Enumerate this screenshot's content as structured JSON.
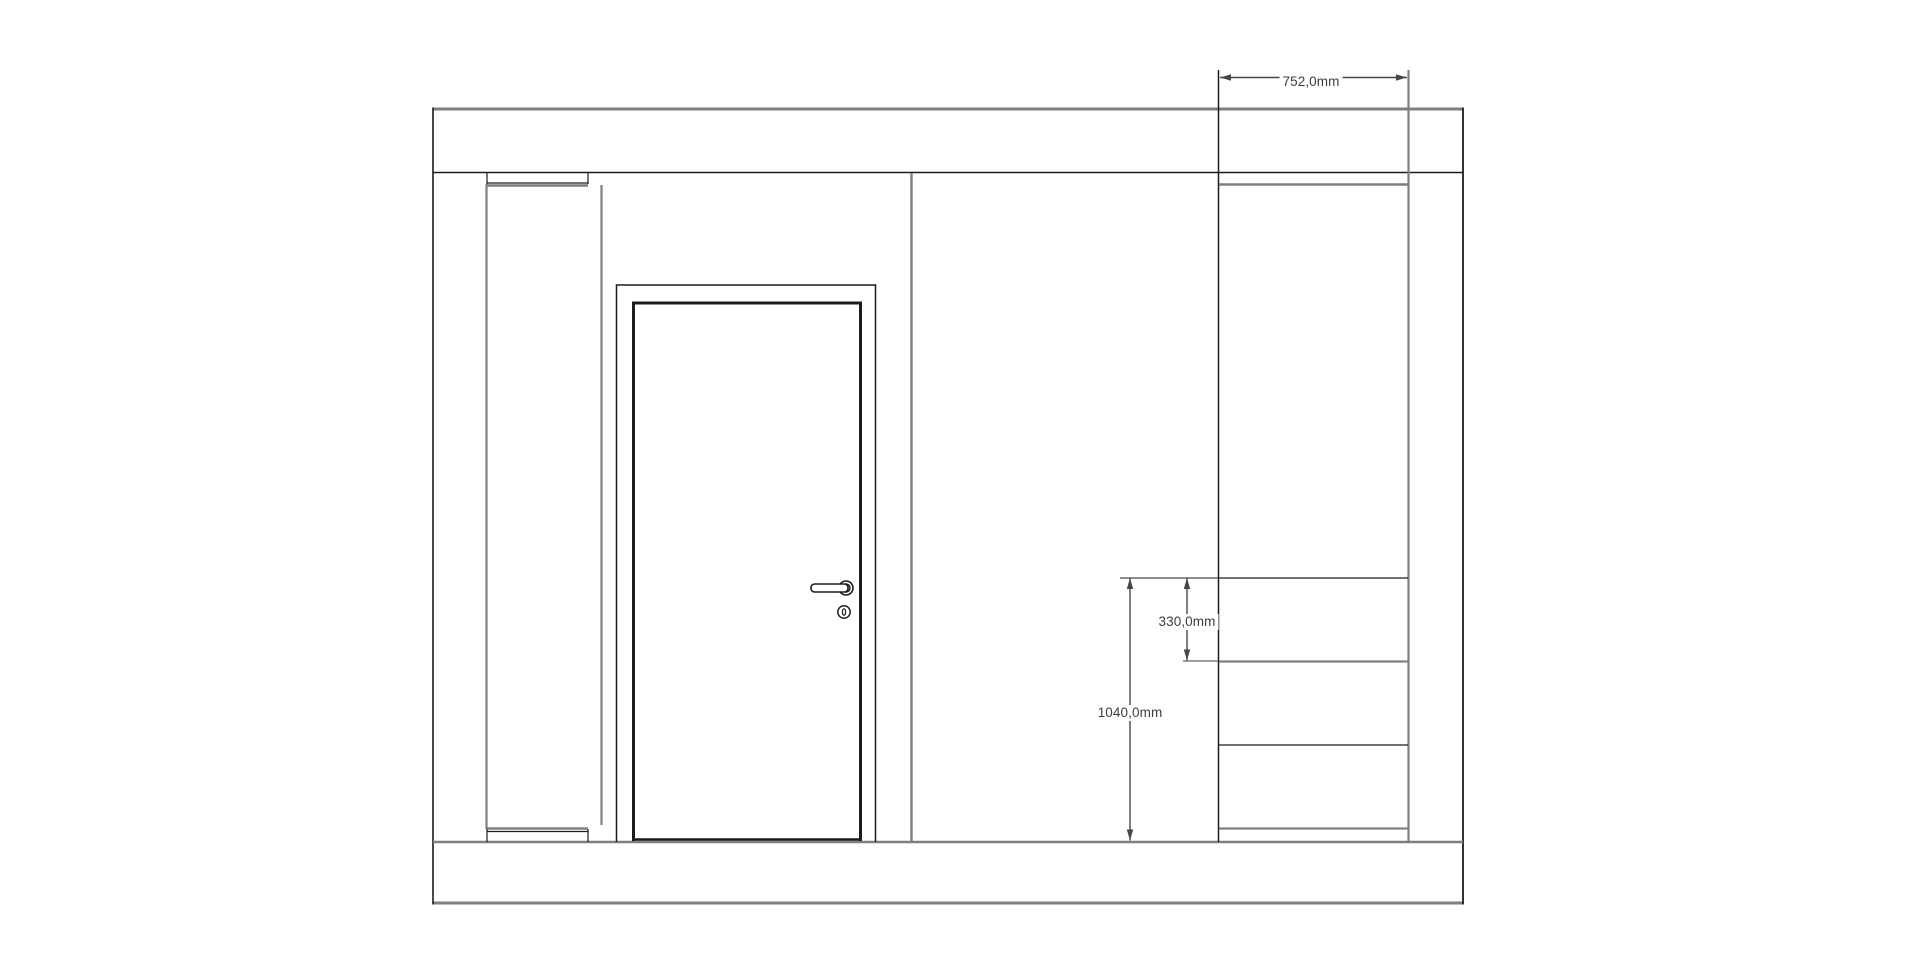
{
  "drawing": {
    "canvas": {
      "width": 1920,
      "height": 954,
      "background": "#ffffff"
    },
    "colors": {
      "gray": "#7f7f7f",
      "dark": "#1c1c1c",
      "dim": "#464646",
      "text": "#3d3d3d",
      "rose_fill": "#d8d8d8",
      "white": "#ffffff"
    },
    "segments": [
      {
        "name": "wall-top-edge",
        "x1": 433,
        "y1": 109,
        "x2": 1463,
        "y2": 109,
        "stroke": "gray",
        "w": 3
      },
      {
        "name": "wall-bottom-edge",
        "x1": 433,
        "y1": 903,
        "x2": 1463,
        "y2": 903,
        "stroke": "gray",
        "w": 3
      },
      {
        "name": "wall-left-edge",
        "x1": 433,
        "y1": 107.5,
        "x2": 433,
        "y2": 904.5,
        "stroke": "dark",
        "w": 1.6
      },
      {
        "name": "wall-right-edge",
        "x1": 1463,
        "y1": 107.5,
        "x2": 1463,
        "y2": 904.5,
        "stroke": "dark",
        "w": 1.8
      },
      {
        "name": "ceiling-line",
        "x1": 433,
        "y1": 172.5,
        "x2": 1463,
        "y2": 172.5,
        "stroke": "dark",
        "w": 1.4
      },
      {
        "name": "floor-line",
        "x1": 433,
        "y1": 842,
        "x2": 1463,
        "y2": 842,
        "stroke": "gray",
        "w": 2.6
      },
      {
        "name": "left-panel-side-edge",
        "x1": 486.5,
        "y1": 184,
        "x2": 486.5,
        "y2": 829,
        "stroke": "gray",
        "w": 2.2
      },
      {
        "name": "left-panel-top-line",
        "x1": 487,
        "y1": 183,
        "x2": 588,
        "y2": 183,
        "stroke": "dark",
        "w": 1.2
      },
      {
        "name": "left-panel-top-face",
        "x1": 486,
        "y1": 185.5,
        "x2": 588,
        "y2": 185.5,
        "stroke": "gray",
        "w": 2.4
      },
      {
        "name": "left-panel-top-stub-left",
        "x1": 487,
        "y1": 172,
        "x2": 487,
        "y2": 184,
        "stroke": "dark",
        "w": 1.2
      },
      {
        "name": "left-panel-top-stub-right",
        "x1": 588,
        "y1": 172,
        "x2": 588,
        "y2": 184,
        "stroke": "dark",
        "w": 1.2
      },
      {
        "name": "left-panel-bottom-face",
        "x1": 486,
        "y1": 828.5,
        "x2": 588,
        "y2": 828.5,
        "stroke": "gray",
        "w": 2.4
      },
      {
        "name": "left-panel-bottom-line",
        "x1": 487,
        "y1": 831.5,
        "x2": 588,
        "y2": 831.5,
        "stroke": "dark",
        "w": 1.2
      },
      {
        "name": "left-panel-bot-stub-left",
        "x1": 487,
        "y1": 829,
        "x2": 487,
        "y2": 842,
        "stroke": "dark",
        "w": 1.2
      },
      {
        "name": "left-panel-bot-stub-right",
        "x1": 588,
        "y1": 829,
        "x2": 588,
        "y2": 842,
        "stroke": "dark",
        "w": 1.2
      },
      {
        "name": "wall-corner-line",
        "x1": 601.5,
        "y1": 185,
        "x2": 601.5,
        "y2": 825,
        "stroke": "gray",
        "w": 2.2
      },
      {
        "name": "door-frame-left",
        "x1": 616.5,
        "y1": 285,
        "x2": 616.5,
        "y2": 842,
        "stroke": "dark",
        "w": 1.5
      },
      {
        "name": "door-frame-right",
        "x1": 875.5,
        "y1": 285,
        "x2": 875.5,
        "y2": 842,
        "stroke": "dark",
        "w": 1.5
      },
      {
        "name": "door-frame-top",
        "x1": 615.8,
        "y1": 285,
        "x2": 876.2,
        "y2": 285,
        "stroke": "dark",
        "w": 1.5
      },
      {
        "name": "door-slab-left",
        "x1": 633.5,
        "y1": 301.5,
        "x2": 633.5,
        "y2": 841,
        "stroke": "dark",
        "w": 3
      },
      {
        "name": "door-slab-right",
        "x1": 860.5,
        "y1": 301.5,
        "x2": 860.5,
        "y2": 841,
        "stroke": "dark",
        "w": 3
      },
      {
        "name": "door-slab-top",
        "x1": 632,
        "y1": 303,
        "x2": 862,
        "y2": 303,
        "stroke": "dark",
        "w": 3
      },
      {
        "name": "door-slab-bottom",
        "x1": 632,
        "y1": 839.5,
        "x2": 862,
        "y2": 839.5,
        "stroke": "dark",
        "w": 2.6
      },
      {
        "name": "wall-partition-line",
        "x1": 911.5,
        "y1": 173,
        "x2": 911.5,
        "y2": 842,
        "stroke": "gray",
        "w": 2.4
      },
      {
        "name": "cabinet-left-edge",
        "x1": 1218.5,
        "y1": 70,
        "x2": 1218.5,
        "y2": 842,
        "stroke": "dark",
        "w": 1.5
      },
      {
        "name": "cabinet-right-edge",
        "x1": 1408.5,
        "y1": 70,
        "x2": 1408.5,
        "y2": 842,
        "stroke": "gray",
        "w": 2.2
      },
      {
        "name": "cabinet-top-edge",
        "x1": 1219,
        "y1": 184.5,
        "x2": 1408,
        "y2": 184.5,
        "stroke": "gray",
        "w": 2.4
      },
      {
        "name": "cabinet-divider-1",
        "x1": 1219,
        "y1": 578,
        "x2": 1408,
        "y2": 578,
        "stroke": "dark",
        "w": 1.3
      },
      {
        "name": "cabinet-divider-2",
        "x1": 1219,
        "y1": 661.5,
        "x2": 1408,
        "y2": 661.5,
        "stroke": "gray",
        "w": 2.2
      },
      {
        "name": "cabinet-divider-3",
        "x1": 1219,
        "y1": 745,
        "x2": 1408,
        "y2": 745,
        "stroke": "dark",
        "w": 1.3
      },
      {
        "name": "cabinet-bottom-edge",
        "x1": 1219,
        "y1": 828.5,
        "x2": 1408,
        "y2": 828.5,
        "stroke": "gray",
        "w": 2.2
      },
      {
        "name": "dim-ext-line-top-drawer",
        "x1": 1120,
        "y1": 578,
        "x2": 1219,
        "y2": 578,
        "stroke": "dark",
        "w": 1
      },
      {
        "name": "dim-ext-tick-drawer-2",
        "x1": 1183,
        "y1": 661,
        "x2": 1218,
        "y2": 661,
        "stroke": "gray",
        "w": 1.5
      }
    ],
    "door_handle": {
      "rose_outer": {
        "cx": 846,
        "cy": 588,
        "r": 7
      },
      "rose_inner": {
        "cx": 846,
        "cy": 588,
        "r": 4
      },
      "lever": {
        "x": 811,
        "y": 584,
        "w": 37,
        "h": 8,
        "rx": 3.5
      },
      "keyhole": {
        "cx": 844,
        "cy": 612,
        "r": 6.2
      },
      "keyhole_slot": {
        "cx": 844,
        "cy": 612,
        "rx": 1.6,
        "ry": 3.3
      }
    },
    "dimensions": [
      {
        "id": "cabinet-width",
        "label": "752,0mm",
        "orientation": "horizontal",
        "x1": 1220,
        "x2": 1407,
        "y": 77.5,
        "label_x": 1311,
        "label_y": 82
      },
      {
        "id": "drawer-height",
        "label": "330,0mm",
        "orientation": "vertical",
        "y1": 578,
        "y2": 660.5,
        "x": 1187,
        "label_x": 1187,
        "label_y": 621.5
      },
      {
        "id": "drawers-height",
        "label": "1040,0mm",
        "orientation": "vertical",
        "y1": 578,
        "y2": 840.5,
        "x": 1130,
        "label_x": 1130,
        "label_y": 712.5
      }
    ],
    "arrow": {
      "length": 11,
      "half_width": 3.2,
      "line_w": 1.4
    }
  }
}
